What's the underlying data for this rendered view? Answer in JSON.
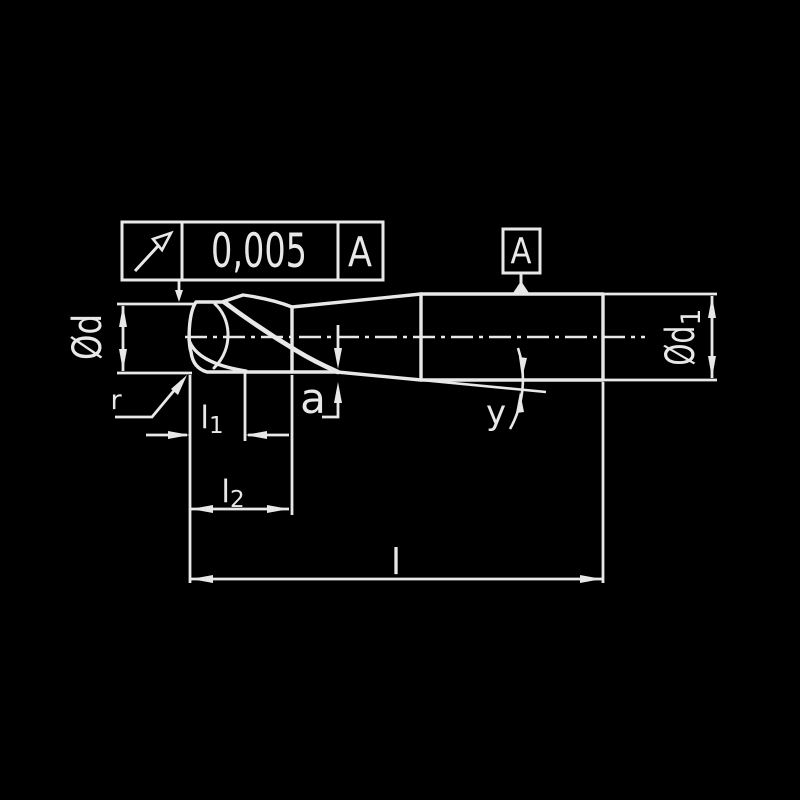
{
  "colors": {
    "background": "#000000",
    "line": "#e8e8e8"
  },
  "tolerance_frame": {
    "symbol_icon": "circular-runout-arrow",
    "value": "0,005",
    "datum_ref": "A"
  },
  "datum_flag": {
    "letter": "A"
  },
  "labels": {
    "dia_head": "Ød",
    "dia_shank_main": "Ød",
    "dia_shank_sub": "1",
    "flute_length_main": "l",
    "flute_length_sub": "1",
    "cut_length_main": "l",
    "cut_length_sub": "2",
    "overall_length": "l",
    "step": "a",
    "angle": "y",
    "corner_radius": "r"
  }
}
